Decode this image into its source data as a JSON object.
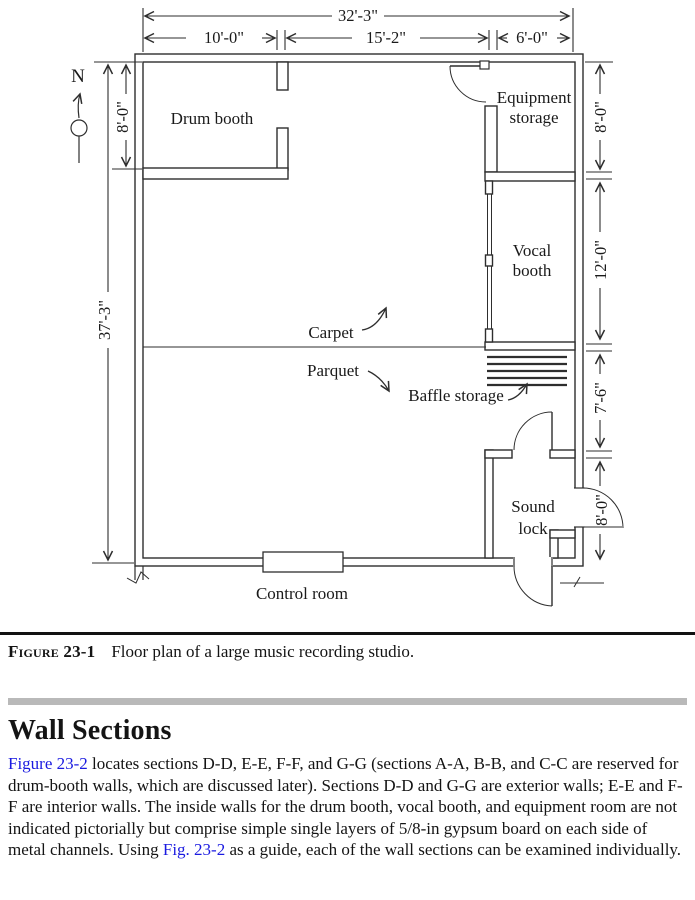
{
  "figure": {
    "north": "N",
    "dimensions": {
      "overall_width": "32'-3\"",
      "drum_booth_width": "10'-0\"",
      "studio_width": "15'-2\"",
      "right_rooms_width": "6'-0\"",
      "overall_height": "37'-3\"",
      "drum_booth_height": "8'-0\"",
      "equipment_storage_height": "8'-0\"",
      "vocal_booth_height": "12'-0\"",
      "baffle_area_height": "7'-6\"",
      "sound_lock_height": "8'-0\""
    },
    "rooms": {
      "drum_booth": "Drum booth",
      "equipment_storage_line1": "Equipment",
      "equipment_storage_line2": "storage",
      "vocal_booth_line1": "Vocal",
      "vocal_booth_line2": "booth",
      "sound_lock_line1": "Sound",
      "sound_lock_line2": "lock",
      "control_room": "Control room"
    },
    "floor_labels": {
      "carpet": "Carpet",
      "parquet": "Parquet",
      "baffle_storage": "Baffle storage"
    }
  },
  "caption": {
    "label": "Figure 23-1",
    "text": "Floor plan of a large music recording studio."
  },
  "section": {
    "heading": "Wall Sections",
    "body": [
      {
        "text": "Figure 23-2",
        "link": true
      },
      {
        "text": " locates sections D-D, E-E, F-F, and G-G (sections A-A, B-B, and C-C are reserved for drum-booth walls, which are discussed later). Sections D-D and G-G are exterior walls; E-E and F-F are interior walls. The inside walls for the drum booth, vocal booth, and equipment room are not indicated pictorially but comprise simple single layers of 5/8-in gypsum board on each side of metal channels. Using ",
        "link": false
      },
      {
        "text": "Fig. 23-2",
        "link": true
      },
      {
        "text": " as a guide, each of the wall sections can be examined individually.",
        "link": false
      }
    ]
  },
  "colors": {
    "line": "#2e2e2e",
    "link": "#1a1ae0",
    "divider_bar": "#b9b9b9",
    "rule": "#111111"
  }
}
